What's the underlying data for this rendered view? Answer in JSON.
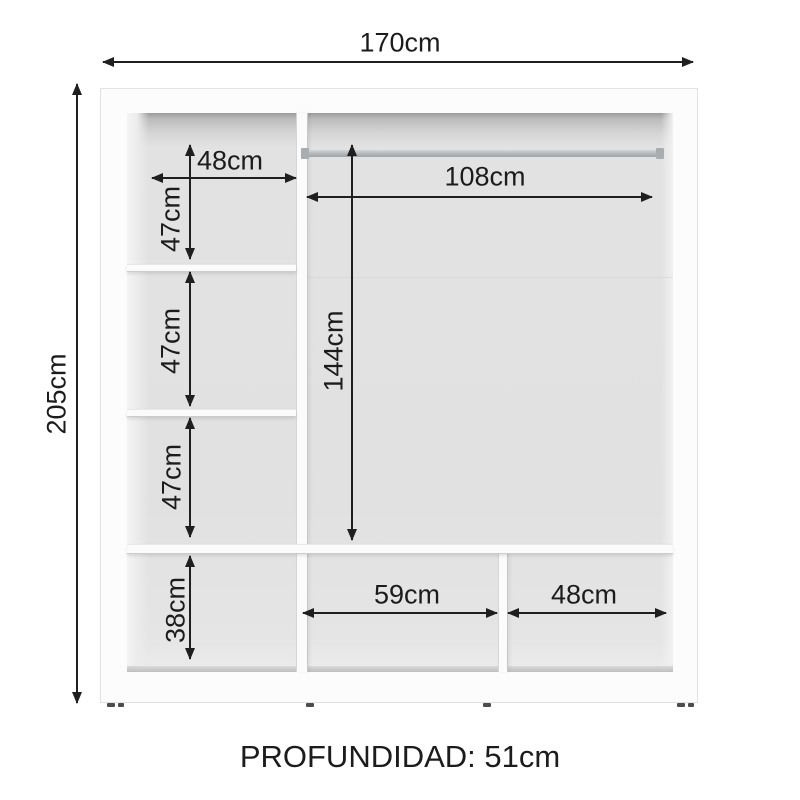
{
  "labels": {
    "overall_width": "170cm",
    "overall_height": "205cm",
    "upper_left_width": "48cm",
    "left_comp_1_height": "47cm",
    "left_comp_2_height": "47cm",
    "left_comp_3_height": "47cm",
    "left_comp_4_height": "38cm",
    "rod_width": "108cm",
    "hanging_height": "144cm",
    "bottom_middle_width": "59cm",
    "bottom_right_width": "48cm"
  },
  "footer": {
    "depth_label": "PROFUNDIDAD: 51cm"
  },
  "measurements_cm": {
    "width": 170,
    "height": 205,
    "depth": 51,
    "left_shelf_width": 48,
    "left_compartment_heights": [
      47,
      47,
      47
    ],
    "left_bottom_compartment_height": 38,
    "hanging_rod_width": 108,
    "hanging_space_height": 144,
    "bottom_middle_width": 59,
    "bottom_right_width": 48
  },
  "colors": {
    "line": "#1f1f1f",
    "interior_gray": "#e2e2e2",
    "top_shadow_gray": "#9c9c9c",
    "rod_gray": "#b2b6b8",
    "cabinet_white": "#fcfcfc"
  }
}
